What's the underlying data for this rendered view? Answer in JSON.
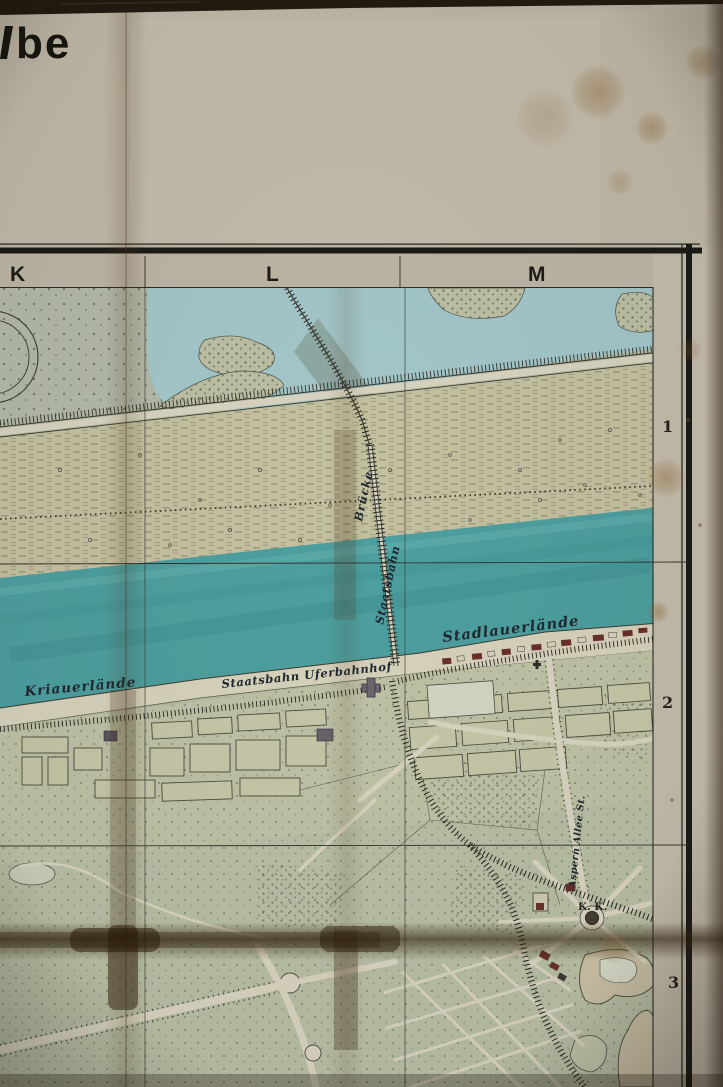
{
  "photo": {
    "title_fragment": "be"
  },
  "grid": {
    "columns": [
      {
        "label": "K"
      },
      {
        "label": "L"
      },
      {
        "label": "M"
      }
    ],
    "rows": [
      {
        "label": "1"
      },
      {
        "label": "2"
      },
      {
        "label": "3"
      }
    ]
  },
  "labels": {
    "bank_left": "Kriauerlände",
    "bank_right": "Stadlauerlände",
    "station": "Staatsbahn Uferbahnhof",
    "bridge_name_1": "Staatsbahn",
    "bridge_name_2": "Brücke",
    "avenue": "Aspern Allee St.",
    "royal_abbrev": "K. K."
  },
  "colors": {
    "river_water": "#4d9fa0",
    "still_water": "#a3c6c9",
    "park_green": "#b6bca3",
    "foreland_sand": "#c4c1a1",
    "paper": "#bdb5a4",
    "label_ink": "#1f2830"
  }
}
